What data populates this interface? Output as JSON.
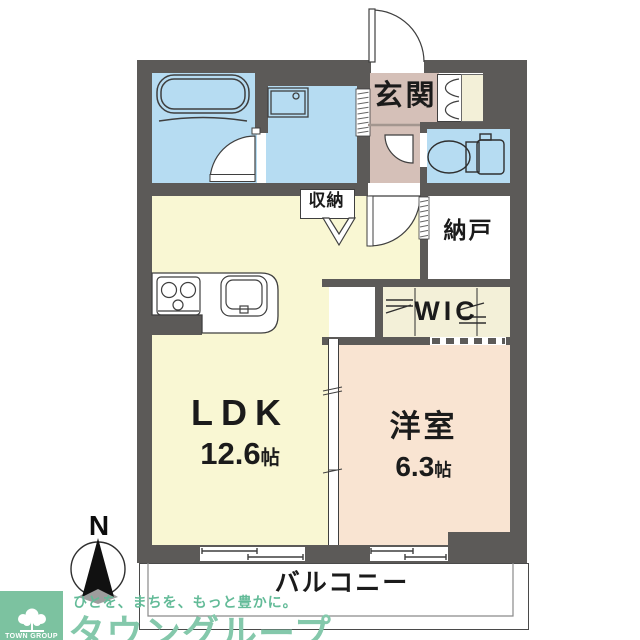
{
  "plan": {
    "compass_north": "N",
    "rooms": {
      "ldk": {
        "name": "LDK",
        "size": "12.6",
        "unit": "帖"
      },
      "western_room": {
        "name": "洋室",
        "size": "6.3",
        "unit": "帖"
      },
      "entrance": {
        "name": "玄関"
      },
      "storeroom": {
        "name": "納戸"
      },
      "walk_in_closet": {
        "name": "WIC"
      },
      "storage": {
        "name": "収納"
      },
      "balcony": {
        "name": "バルコニー"
      }
    }
  },
  "branding": {
    "tagline": "ひとを、まちを、もっと豊かに。",
    "brand_name": "タウングループ",
    "logo_caption": "TOWN GROUP"
  },
  "colors": {
    "wall": "#5c5a58",
    "water_rooms": "#b6dcf2",
    "ldk_floor": "#f9f7d3",
    "entrance_floor": "#d5c0b8",
    "bedroom_floor": "#f9e4d2",
    "closet_floor": "#f3f0d8",
    "brand_green": "#7cc2a0"
  }
}
